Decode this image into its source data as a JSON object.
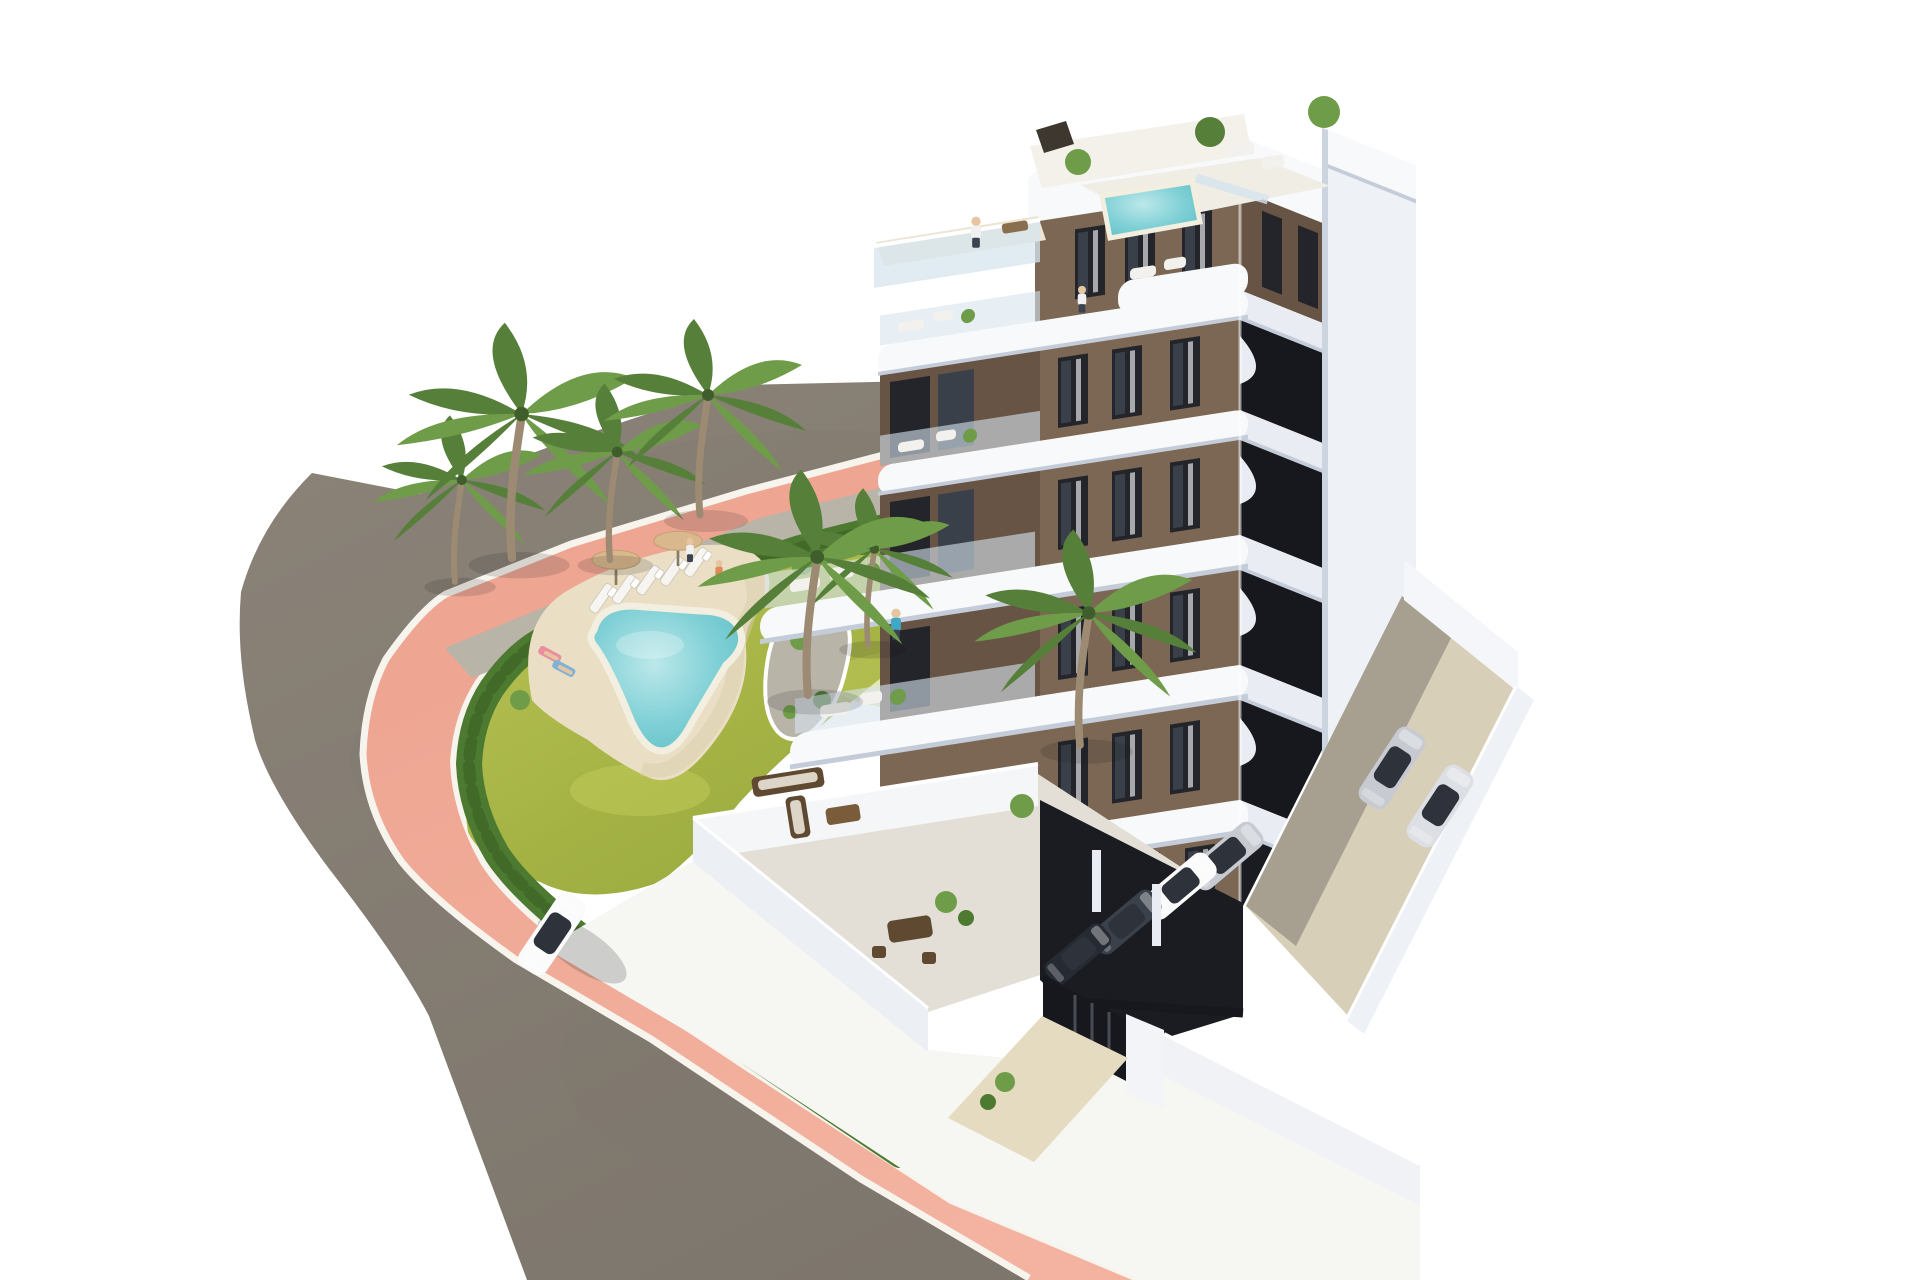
{
  "meta": {
    "type": "architectural-3d-render",
    "description": "Aerial 3D rendering of a modern seven-storey white and brown apartment building with a rooftop terrace and plunge pool, curved white balconies, a landscaped garden with a kidney-shaped swimming pool, sun loungers, parasols and palm trees, a curved asphalt road with a pink sidewalk, a white car driving by, a side parking yard with two silver cars and a covered garage with parked cars",
    "visible_text": []
  },
  "palette": {
    "bg": "#ffffff",
    "asphalt": "#8b8378",
    "asphaltDark": "#7d766c",
    "sidewalkPink": "#eca18d",
    "sidewalkLight": "#f3b3a0",
    "curb": "#f7f4ee",
    "lawn": "#a4b244",
    "lawnDark": "#8ba03a",
    "lawnLight": "#c0ca5a",
    "hedge": "#4d7a31",
    "hedgeDark": "#3e6527",
    "gravel": "#b8b4a8",
    "stone": "#a8a499",
    "deck": "#eadfc4",
    "deckShade": "#d9cdae",
    "pool": "#7fd0d6",
    "poolDeep": "#5fbfc7",
    "poolLight": "#bce8ea",
    "poolRim": "#f2eee0",
    "white1": "#f8f9fb",
    "white2": "#e9edf3",
    "white3": "#d9dfe9",
    "shadeLine": "#c3ccd8",
    "brown": "#7b6753",
    "brown2": "#675444",
    "windowDark": "#24252b",
    "windowGlass": "#3a4049",
    "curtain": "#eceef0",
    "glass": "#d7e4ee",
    "dark": "#17181d",
    "towerFace": "#eef1f6",
    "towerShade": "#ccd4e0",
    "parkGround": "#d8cfb9",
    "garage": "#1b1c21",
    "carSilver": "#c7cbd1",
    "carSilver2": "#dcdfe3",
    "carDark": "#3a414b",
    "carDark2": "#262b33",
    "carWhite": "#fbfbfb",
    "carGlass": "#2e333b",
    "umbrella": "#d8b88c",
    "trunk": "#9c8b72",
    "frond": "#567f3a",
    "frond2": "#6f9c49",
    "skin": "#e7c5a1",
    "teal": "#3fa9c4",
    "pants": "#3a434f",
    "shirtWhite": "#f1f1f1",
    "swimOrange": "#e08a5a",
    "towelPink": "#e88fa0",
    "towelBlue": "#7fb3d5",
    "furnBrown": "#5f4a31",
    "furnLight": "#ddd6c8",
    "shadow": "#14141a"
  },
  "scene": {
    "building": {
      "floors_visible": 7,
      "features": [
        "rooftop terrace with plunge pool and glass fence",
        "penthouse terrace with glass parapet",
        "stacked curved white balconies on garden face",
        "brown facade panels with dark full-height windows",
        "dark recessed balcony bands on street face",
        "white corner tower volume",
        "ground-floor terrace with outdoor lounge furniture",
        "covered parking garage with parked cars",
        "black entrance gate with white pillar and wall"
      ]
    },
    "garden": {
      "features": [
        "kidney-shaped swimming pool with cream rim",
        "sand-coloured sun deck",
        "five sun loungers",
        "two parasols",
        "lawn",
        "perimeter hedge along sidewalk",
        "gravel planting strip with shrubs",
        "palm trees",
        "palm island planting bed"
      ],
      "palm_tree_count": 7
    },
    "circulation": {
      "features": [
        "curved asphalt road wrapping the corner plot",
        "pink pedestrian sidewalk with white curbs",
        "beige driveway to garage",
        "side parking yard enclosed by white walls"
      ]
    },
    "vehicles": [
      "white car driving on the road",
      "two silver cars in the side parking yard",
      "silver, white and dark cars inside the covered garage"
    ],
    "people": [
      "person on penthouse terrace",
      "person on upper balcony",
      "person in teal on mid-level wrap terrace",
      "two people standing by the pool lawn",
      "two sunbathers on towels on the pool deck"
    ]
  }
}
